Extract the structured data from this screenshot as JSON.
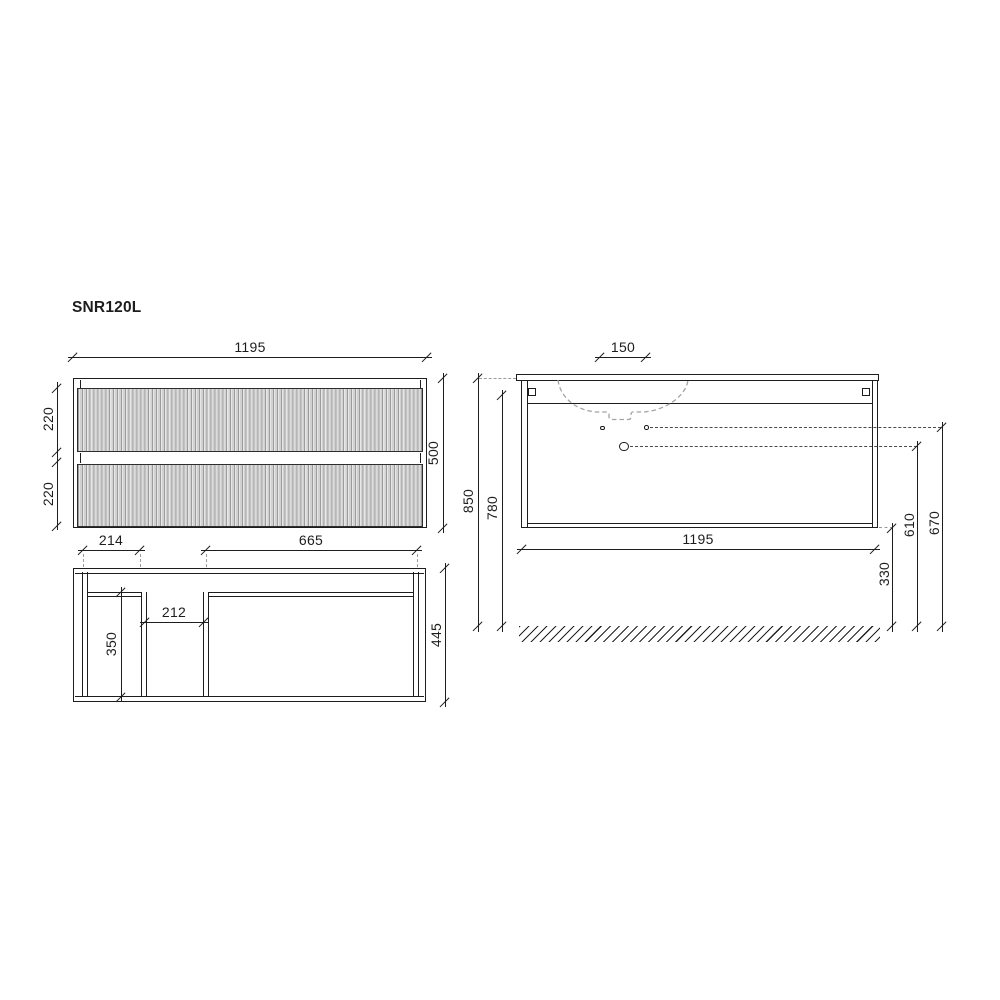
{
  "title": "SNR120L",
  "colors": {
    "line": "#1d1d1b",
    "dashed_gray": "#9b9b9b",
    "flute_fill": "#d9d9d9"
  },
  "front_view": {
    "width": "1195",
    "height": "500",
    "top_drawer_height": "220",
    "bottom_drawer_height": "220"
  },
  "plan_view": {
    "left_section_width": "214",
    "right_section_width": "665",
    "center_gap_width": "212",
    "inner_depth": "350",
    "total_depth": "445"
  },
  "side_view": {
    "hole_spacing": "150",
    "total_height": "850",
    "mounting_height": "780",
    "width": "1195",
    "bottom_clearance": "330",
    "drain_height": "610",
    "overflow_height": "670"
  }
}
